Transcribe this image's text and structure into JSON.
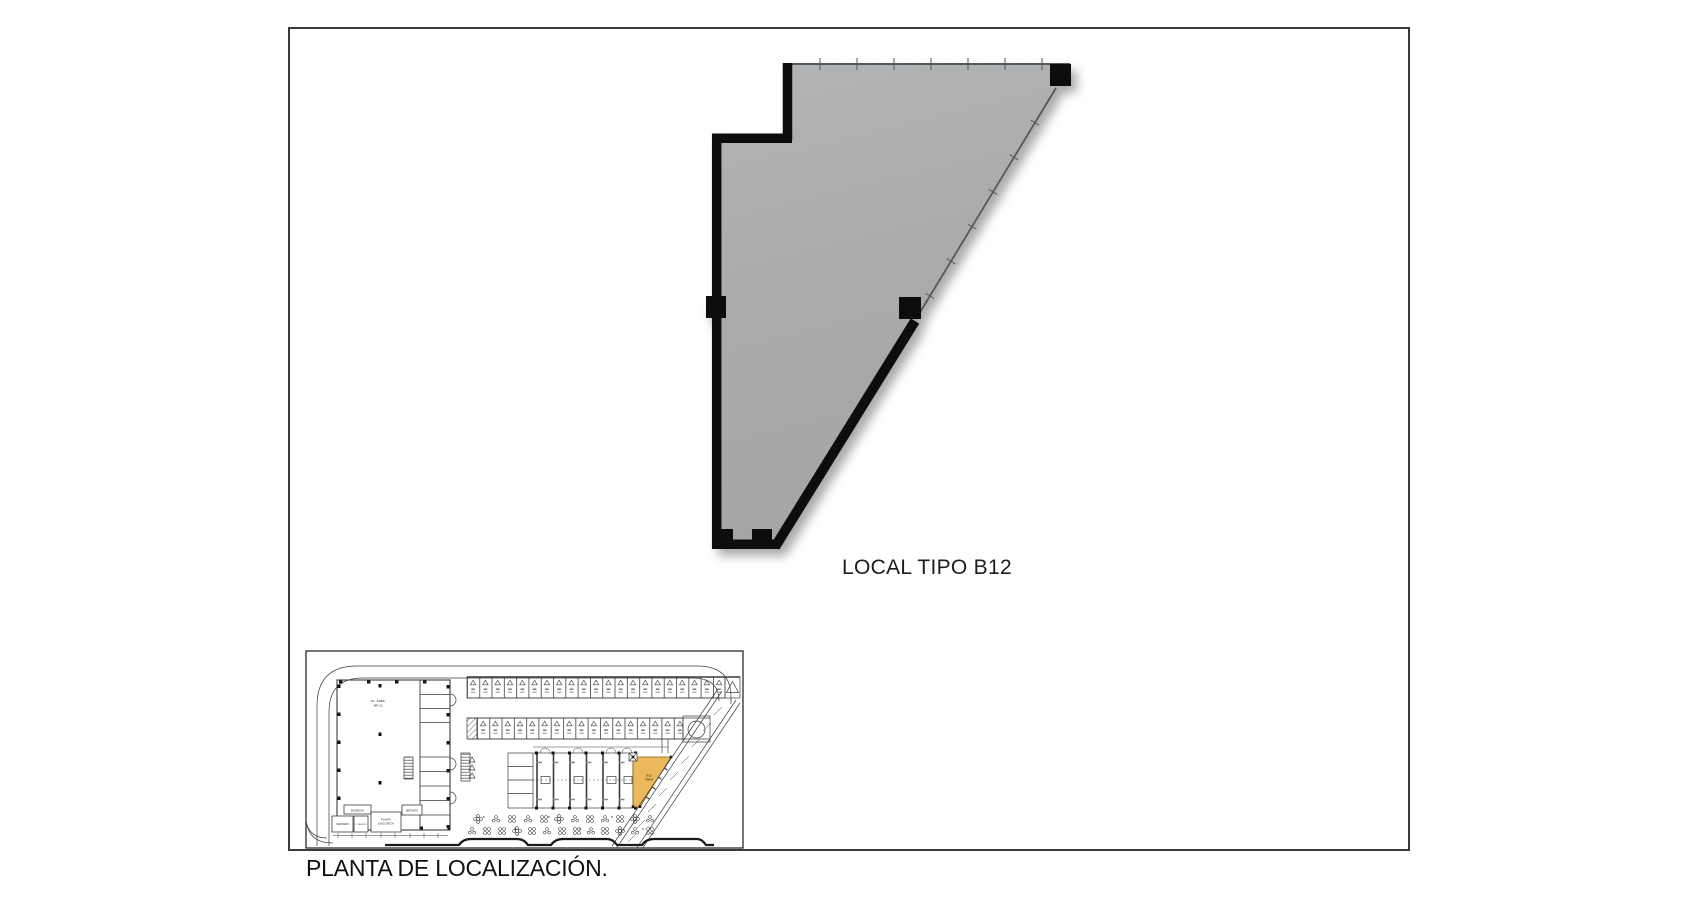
{
  "labels": {
    "local_title": "LOCAL TIPO B12",
    "caption": "PLANTA DE LOCALIZACIÓN."
  },
  "floor_plan": {
    "unit_name": "LOCAL TIPO B12",
    "floor_fill_color": "#a9abac",
    "wall_color": "#0c0c0c",
    "glazing_top_ticks": 7,
    "glazing_diagonal_ticks": 6,
    "column_count": 5
  },
  "location_plan": {
    "highlight_color": "#ecb85c",
    "highlight_outline": "#7d5c16",
    "line_color": "#3c3c3c",
    "frame_color": "#2b2b2b",
    "building_label": {
      "line1": "PL. ÁREA",
      "line2": "MP-13"
    },
    "unit_label": {
      "line1": "B12",
      "line2": "ÁREA"
    },
    "legend_boxes": [
      {
        "l1": "BODEGAS",
        "l2": ""
      },
      {
        "l1": "SANITARIO",
        "l2": ""
      },
      {
        "l1": "C. DE MTS.",
        "l2": ""
      },
      {
        "l1": "PLANTA",
        "l2": "DISCOTECA"
      },
      {
        "l1": "DEPOSITO",
        "l2": ""
      }
    ],
    "parking": {
      "top_row_stalls": 21,
      "second_row_stalls": 17
    }
  }
}
